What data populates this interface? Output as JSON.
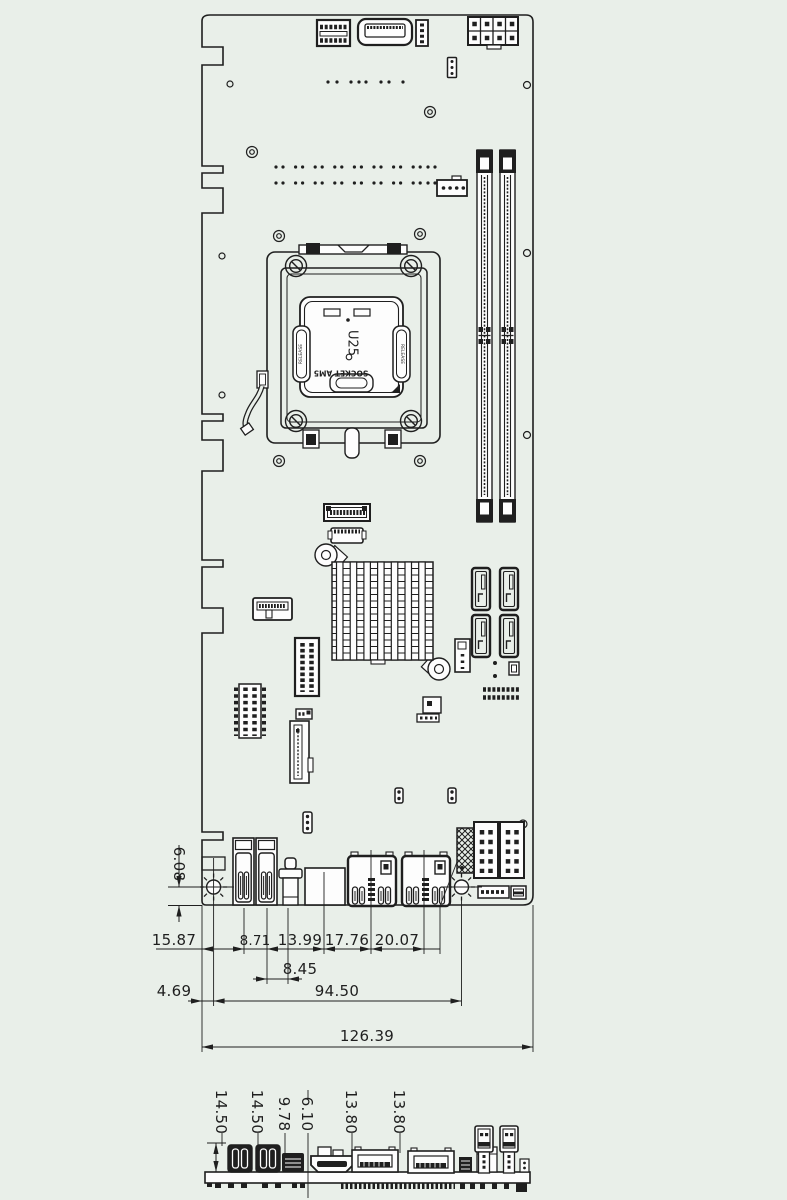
{
  "drawing": {
    "background_color": "#e9efe9",
    "line_color": "#1f1f1f"
  },
  "socket": {
    "ref_designator": "U25",
    "socket_name": "SOCKET AM5",
    "latch_left_label": "RELEASE",
    "latch_right_label": "RELEASE"
  },
  "dimensions_top_view": {
    "hole_to_edge": "6.08",
    "chain": [
      "15.87",
      "8.71",
      "13.99",
      "17.76",
      "20.07"
    ],
    "audio_offset": "8.45",
    "hole_inset": "4.69",
    "hole_span": "94.50",
    "board_width": "126.39"
  },
  "dimensions_side_view": {
    "heights": [
      "14.50",
      "14.50",
      "9.78",
      "6.10",
      "13.80",
      "13.80"
    ]
  }
}
